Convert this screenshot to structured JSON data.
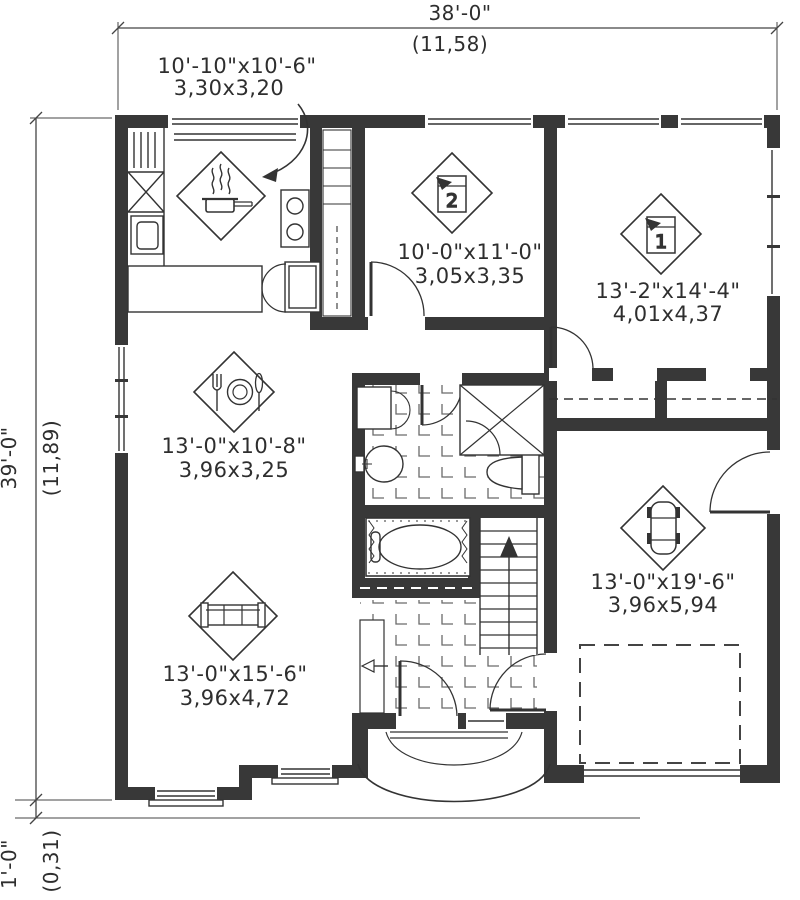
{
  "title": "House first-floor plan",
  "dimensions": {
    "overall_width": {
      "imperial": "38'-0\"",
      "metric": "(11,58)"
    },
    "overall_depth": {
      "imperial": "39'-0\"",
      "metric": "(11,89)"
    },
    "porch_offset": {
      "imperial": "1'-0\"",
      "metric": "(0,31)"
    }
  },
  "rooms": [
    {
      "id": "kitchen",
      "icon": "cooking-pot-icon",
      "imperial": "10'-10\"x10'-6\"",
      "metric": "3,30x3,20"
    },
    {
      "id": "bedroom-2",
      "icon": "bed-number-icon",
      "number": "2",
      "imperial": "10'-0\"x11'-0\"",
      "metric": "3,05x3,35"
    },
    {
      "id": "bedroom-1",
      "icon": "bed-number-icon",
      "number": "1",
      "imperial": "13'-2\"x14'-4\"",
      "metric": "4,01x4,37"
    },
    {
      "id": "dining-room",
      "icon": "plate-cutlery-icon",
      "imperial": "13'-0\"x10'-8\"",
      "metric": "3,96x3,25"
    },
    {
      "id": "living-room",
      "icon": "sofa-icon",
      "imperial": "13'-0\"x15'-6\"",
      "metric": "3,96x4,72"
    },
    {
      "id": "garage",
      "icon": "car-icon",
      "imperial": "13'-0\"x19'-6\"",
      "metric": "3,96x5,94"
    }
  ]
}
